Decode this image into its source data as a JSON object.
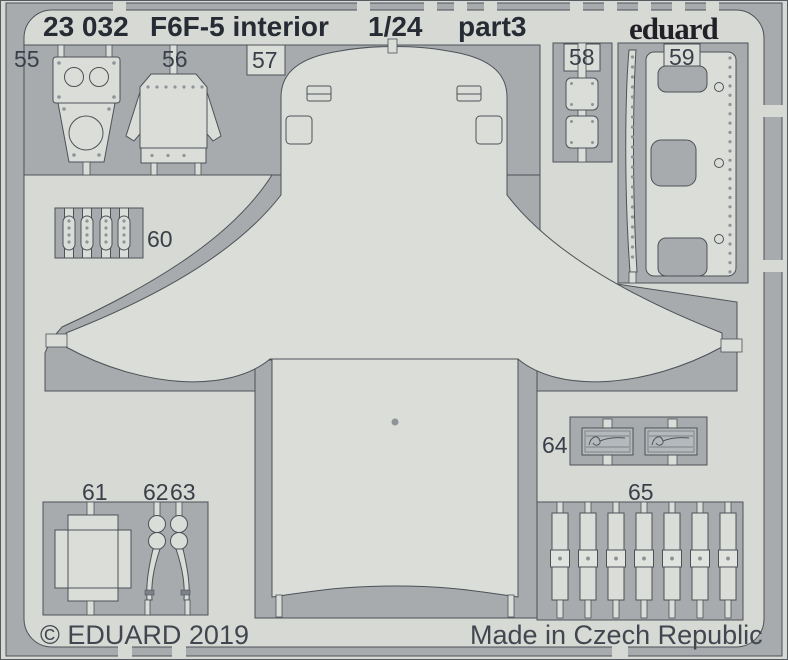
{
  "header": {
    "catalog_number": "23 032",
    "product_name": "F6F-5 interior",
    "scale": "1/24",
    "part_label": "part3",
    "brand": "eduard"
  },
  "part_labels": {
    "p55": "55",
    "p56": "56",
    "p57": "57",
    "p58": "58",
    "p59": "59",
    "p60": "60",
    "p61": "61",
    "p62": "62",
    "p63": "63",
    "p64": "64",
    "p65": "65"
  },
  "footer": {
    "copyright": "© EDUARD 2019",
    "made_in": "Made in Czech Republic"
  },
  "colors": {
    "sheet": "#d7d9d5",
    "part": "#dbddd9",
    "etch": "#a7abae",
    "outline": "#4d5257",
    "print": "#262b34",
    "label": "#3a4049",
    "footer": "#42474f",
    "brand": "#221f27",
    "plate": "#b5b9bb",
    "dot": "#8f9499",
    "band": "#7d828a",
    "buckle": "#e1e3df"
  }
}
